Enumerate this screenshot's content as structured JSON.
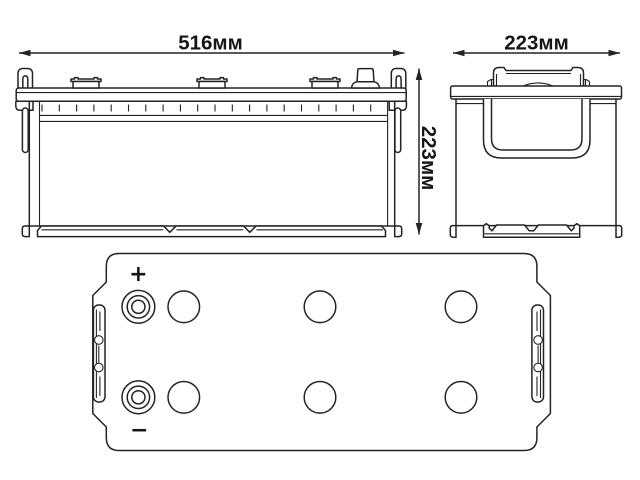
{
  "colors": {
    "background": "#ffffff",
    "line": "#232323",
    "text": "#161616"
  },
  "front_view": {
    "width_label": "516мм",
    "height_label": "223мм"
  },
  "side_view": {
    "depth_label": "223мм"
  },
  "top_view": {
    "positive_label": "+",
    "negative_label": "−"
  }
}
